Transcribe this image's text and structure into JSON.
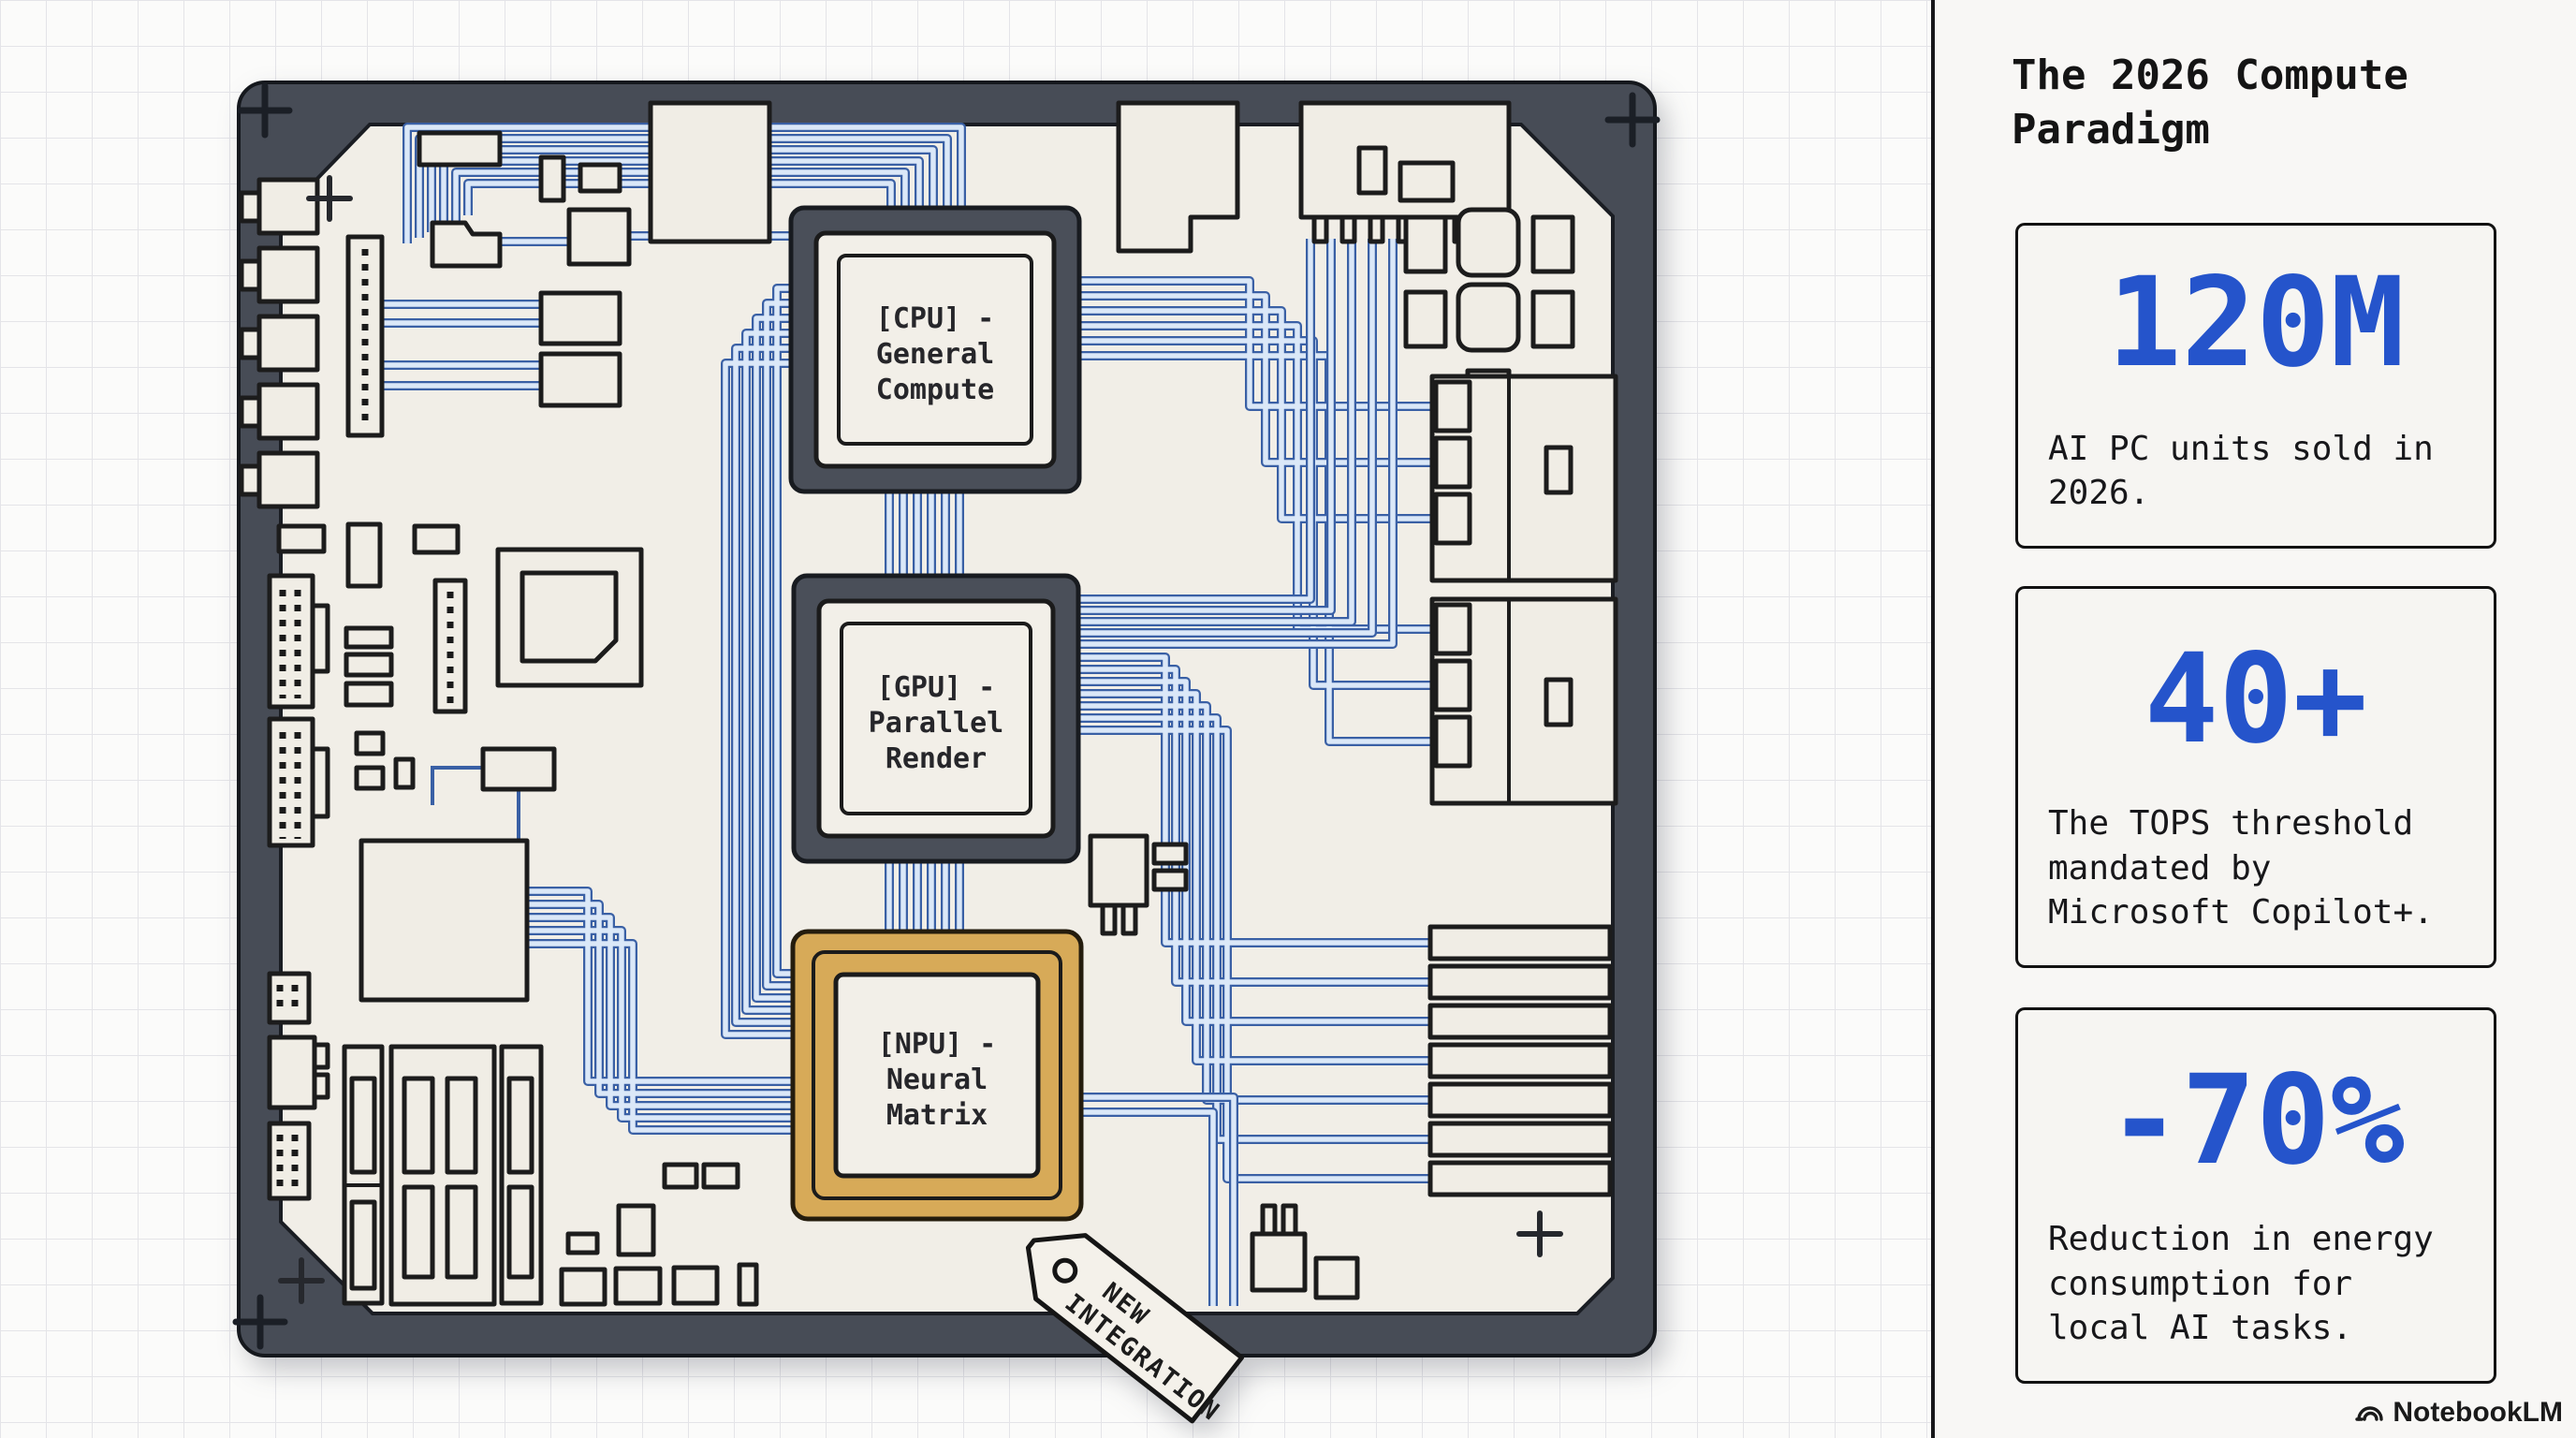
{
  "board": {
    "chips": [
      {
        "id": "cpu",
        "lines": [
          "[CPU] -",
          "General",
          "Compute"
        ],
        "border_color": "#4a4f59"
      },
      {
        "id": "gpu",
        "lines": [
          "[GPU] -",
          "Parallel",
          "Render"
        ],
        "border_color": "#4a4f59"
      },
      {
        "id": "npu",
        "lines": [
          "[NPU] -",
          "Neural",
          "Matrix"
        ],
        "border_color": "#d7aa58"
      }
    ],
    "tag": {
      "line1": "NEW",
      "line2": "INTEGRATION"
    },
    "trace_color": "#3a60a5",
    "board_frame_color": "#474c56",
    "board_fill_color": "#f1eee7"
  },
  "panel": {
    "title": "The 2026 Compute Paradigm",
    "accent": "#2554cb",
    "cards": [
      {
        "value": "120M",
        "desc": "AI PC units sold in 2026."
      },
      {
        "value": "40+",
        "desc": "The TOPS threshold mandated by Microsoft Copilot+."
      },
      {
        "value": "-70%",
        "desc": "Reduction in energy consumption for local AI tasks."
      }
    ]
  },
  "watermark": {
    "text": "NotebookLM"
  }
}
